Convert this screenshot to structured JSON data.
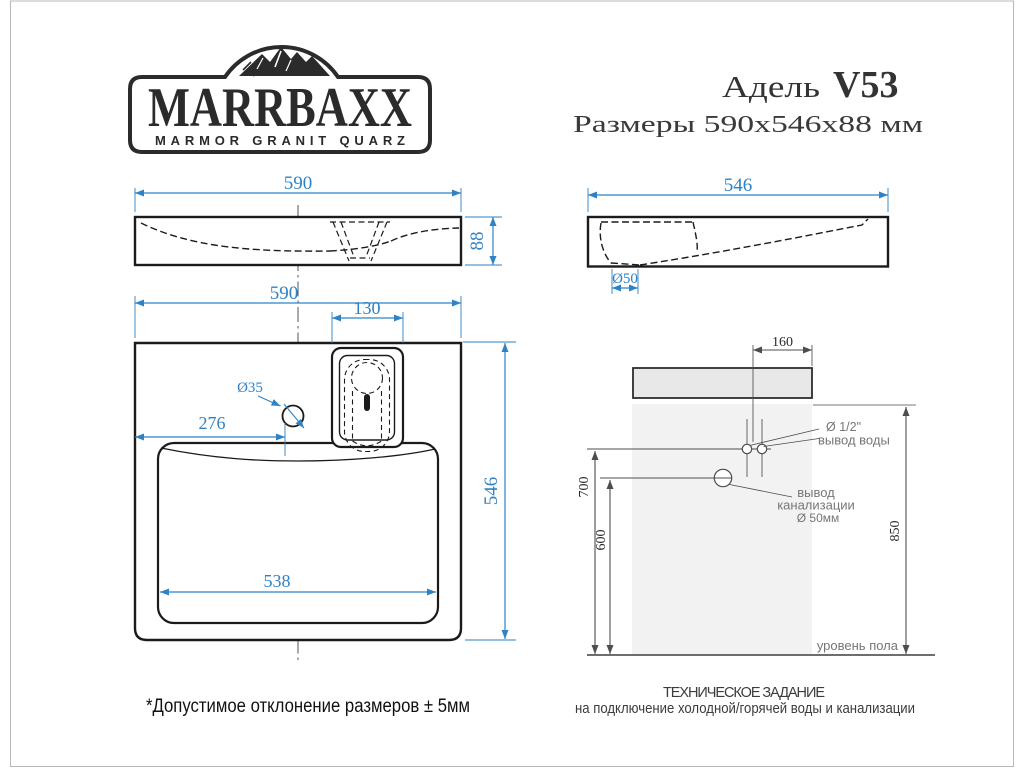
{
  "logo": {
    "brand": "MARRBAXX",
    "tagline": "MARMOR GRANIT QUARZ"
  },
  "header": {
    "model_name": "Адель",
    "model_code": "V53",
    "size_line": "Размеры 590х546х88 мм"
  },
  "front_view": {
    "width_mm": "590",
    "height_mm": "88"
  },
  "side_view": {
    "depth_mm": "546",
    "drain_diameter": "Ø50"
  },
  "top_view": {
    "width_mm": "590",
    "tap_platform_width_mm": "130",
    "tap_hole_diameter": "Ø35",
    "tap_hole_offset_mm": "276",
    "bowl_width_mm": "538",
    "depth_mm": "546"
  },
  "installation": {
    "tap_offset_mm": "160",
    "water_outlet_height_mm": "700",
    "drain_height_mm": "600",
    "worktop_height_mm": "850",
    "water_outlet_label_line1": "Ø 1/2\"",
    "water_outlet_label_line2": "вывод воды",
    "drain_label_line1": "вывод",
    "drain_label_line2": "канализации",
    "drain_label_line3": "Ø 50мм",
    "floor_label": "уровень пола"
  },
  "notes": {
    "tolerance": "*Допустимое отклонение размеров ± 5мм",
    "spec_title": "ТЕХНИЧЕСКОЕ ЗАДАНИЕ",
    "spec_subtitle": "на подключение холодной/горячей воды и канализации"
  },
  "colors": {
    "dimension_blue": "#2e82c5",
    "drawing_black": "#1b1b1b",
    "installation_gray": "#4d4d4d",
    "slab_fill": "#e8e8e8",
    "wall_fill": "#f2f2f2",
    "logo_black": "#2b2b2b",
    "frame_gray": "#b8b8b8"
  }
}
